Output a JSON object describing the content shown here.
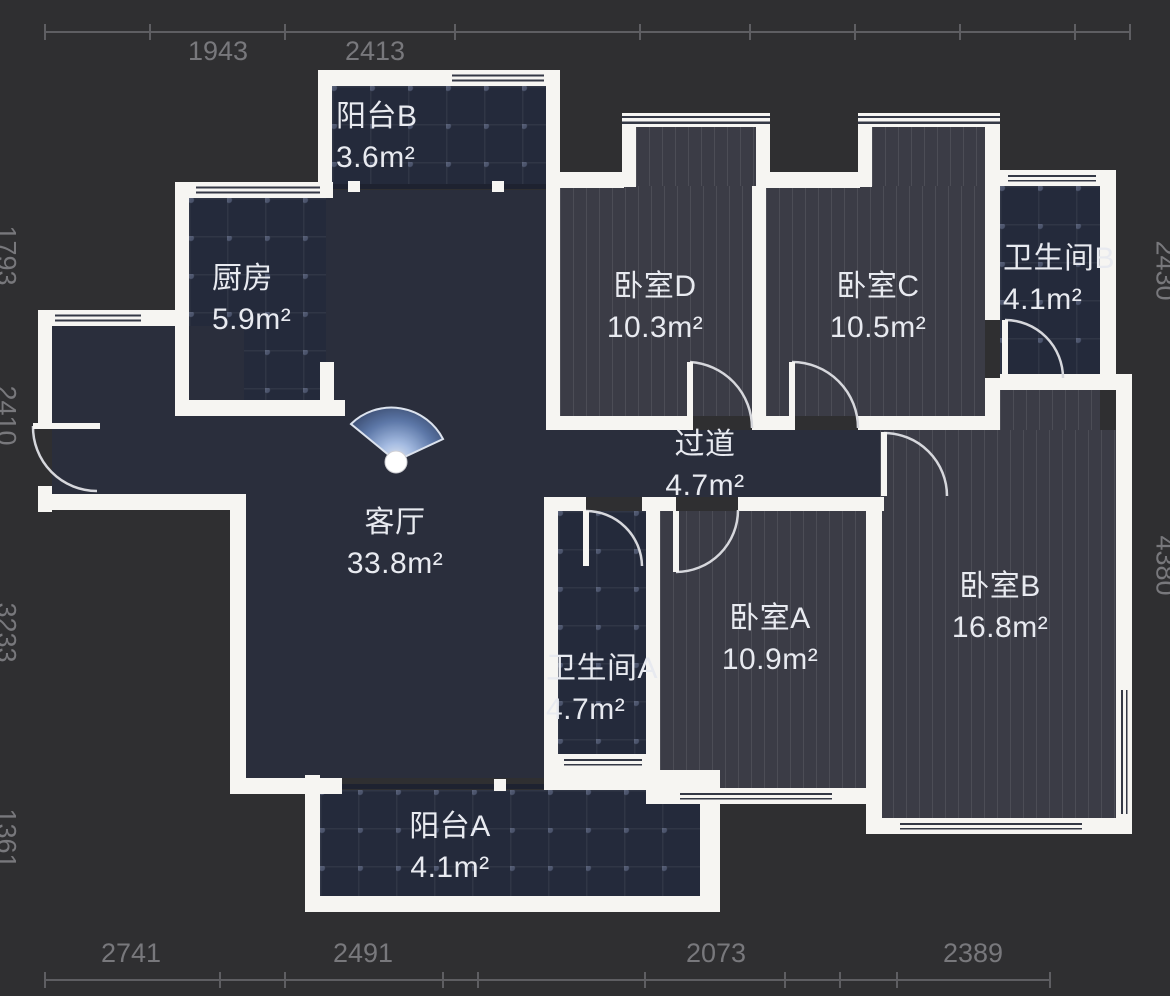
{
  "palette": {
    "background": "#2f2f31",
    "wall": "#f6f5f2",
    "floor_plain": "#2a2e3c",
    "floor_tile": "#242a3b",
    "floor_wood": "#3b3c46",
    "dimension_text": "#78787c",
    "label_text": "#e8eaf0",
    "fan_blue": "#6f8cc0"
  },
  "dimensions": {
    "top": [
      "1943",
      "2413"
    ],
    "bottom": [
      "2741",
      "2491",
      "2073",
      "2389"
    ],
    "left": [
      "1793",
      "2410",
      "3233",
      "1361"
    ],
    "right": [
      "2430",
      "4380"
    ]
  },
  "rooms": {
    "balcony_b": {
      "name": "阳台B",
      "area": "3.6m²"
    },
    "kitchen": {
      "name": "厨房",
      "area": "5.9m²"
    },
    "bedroom_d": {
      "name": "卧室D",
      "area": "10.3m²"
    },
    "bedroom_c": {
      "name": "卧室C",
      "area": "10.5m²"
    },
    "bathroom_b": {
      "name": "卫生间B",
      "area": "4.1m²"
    },
    "hallway": {
      "name": "过道",
      "area": "4.7m²"
    },
    "living": {
      "name": "客厅",
      "area": "33.8m²"
    },
    "bathroom_a": {
      "name": "卫生间A",
      "area": "4.7m²"
    },
    "bedroom_a": {
      "name": "卧室A",
      "area": "10.9m²"
    },
    "bedroom_b": {
      "name": "卧室B",
      "area": "16.8m²"
    },
    "balcony_a": {
      "name": "阳台A",
      "area": "4.1m²"
    }
  }
}
